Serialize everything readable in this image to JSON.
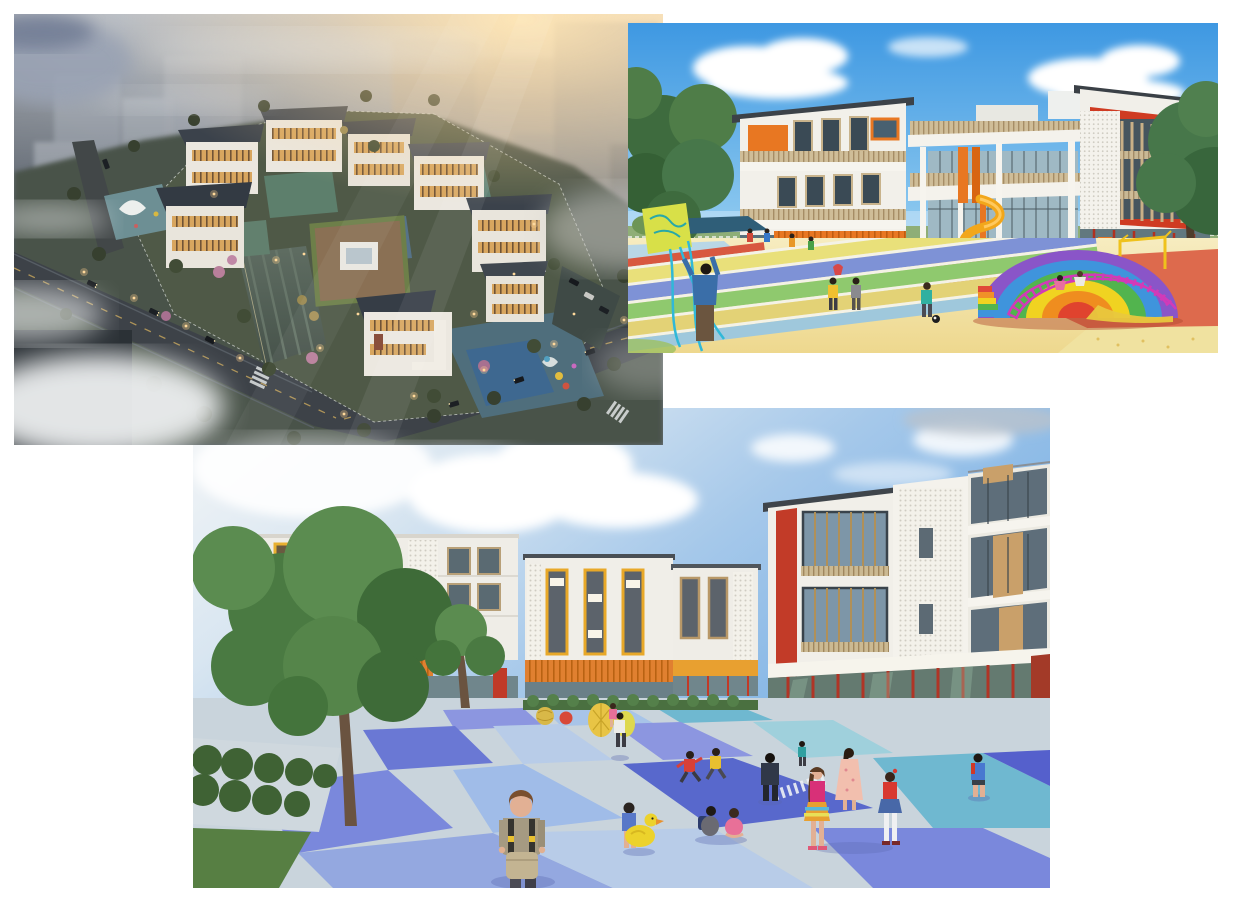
{
  "page": {
    "background_color": "#ffffff",
    "description": "Collage of three architectural renderings of a kindergarten campus on a white page"
  },
  "panels": [
    {
      "id": "aerial-dusk-rendering",
      "alt": "Aerial dusk rendering of a kindergarten campus: white buildings with dark pitched roofs and warm lit windows around green courtyards, a striped entrance plaza, perimeter roads with cars and street lights, hazy city blocks behind, drifting white fog and a warm sunset glow at the upper right",
      "palette": {
        "haze_warm": "#e3cfae",
        "haze_blue": "#8e96a2",
        "roof_dark": "#3b424b",
        "wall_white": "#ebe7df",
        "lit_window_amber": "#d8a65f",
        "courtyard_green": "#5d7f6c",
        "play_teal": "#4f6e7c",
        "grass_dark": "#4f5947",
        "road_gray": "#3d4248",
        "fog_white": "#eff1f2"
      }
    },
    {
      "id": "playground-elevation-rendering",
      "alt": "Eye-level rendering of a white three-storey kindergarten with orange panels, wood-slat balcony railings, a yellow spiral slide between piloti columns, a red-framed louvered wing, children flying a kite and playing football on a rainbow running track, and a rainbow dome climber on red play ground under a blue sky with clouds",
      "palette": {
        "sky_blue": "#3e98e2",
        "cloud_white": "#ffffff",
        "wall_white": "#f2f0ea",
        "accent_orange": "#e87722",
        "accent_red": "#cf3b22",
        "wood_slat": "#cfbd98",
        "slide_yellow": "#f2a71b",
        "sand_yellow": "#f0e09a",
        "track_blue": "#7e92d6",
        "track_green": "#8fc96e",
        "dome_purple": "#8a55c8",
        "dome_yellow": "#f0d321",
        "play_red_ground": "#dd6a4d"
      }
    },
    {
      "id": "courtyard-plaza-rendering",
      "alt": "Courtyard rendering of white kindergarten buildings with red, yellow, orange and wood accents, perforated white screens and glass ground floors around a blue and periwinkle checkered plaza with gray walkways, big green trees at the left, yellow egg-shaped play sculptures and children walking, running and sitting under a partly cloudy sky",
      "palette": {
        "sky_blue": "#79b0e4",
        "cloud_white": "#f4f6f7",
        "wall_white": "#f0eee8",
        "accent_red": "#c23b28",
        "accent_yellow": "#e8a828",
        "accent_orange": "#e08030",
        "wood_panel": "#c9a06a",
        "plaza_periwinkle": "#7b86dd",
        "plaza_deep_blue": "#5560cc",
        "plaza_light_blue": "#b8cce8",
        "plaza_teal": "#66b4cc",
        "walkway_gray": "#ccd6de",
        "tree_green": "#4a7a42"
      }
    }
  ]
}
